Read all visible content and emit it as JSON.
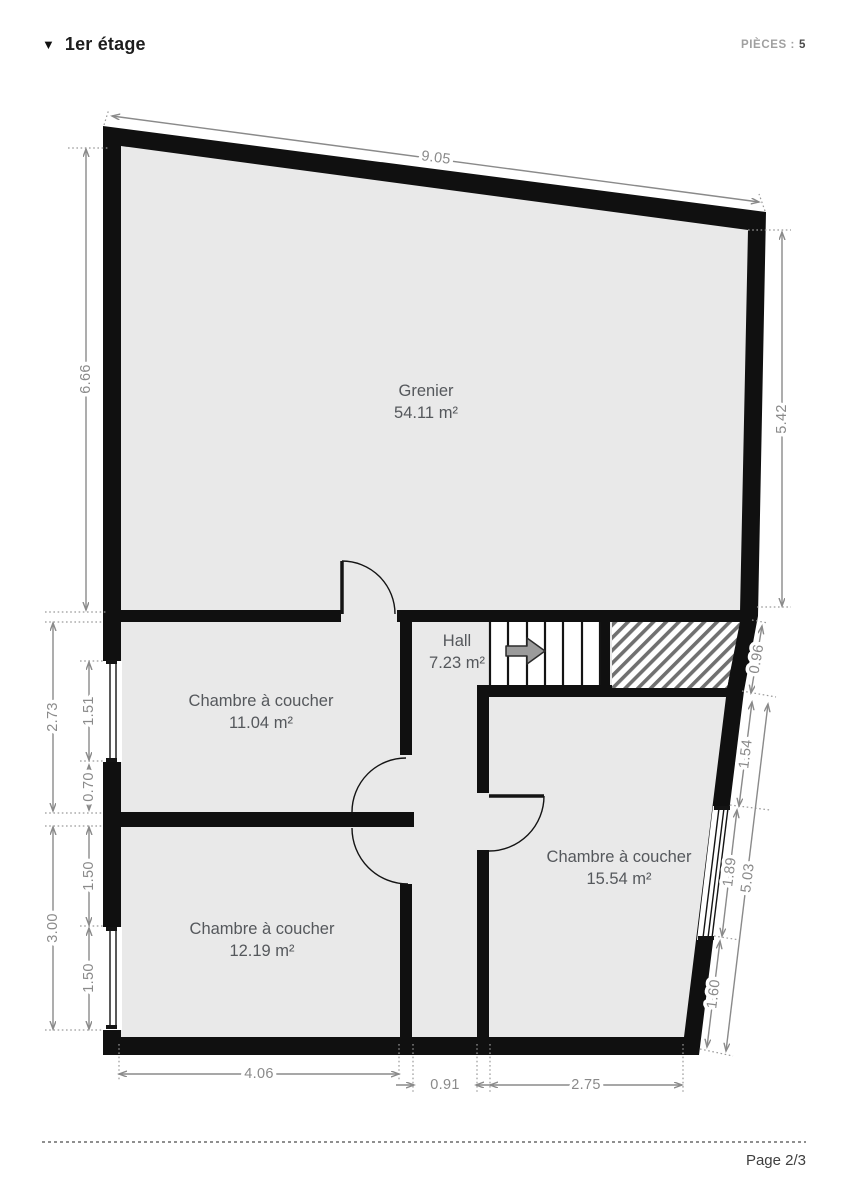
{
  "header": {
    "collapse_icon": "▼",
    "title": "1er étage",
    "rooms_label": "PIÈCES :",
    "rooms_count": "5"
  },
  "floorplan": {
    "rooms": {
      "grenier": {
        "name": "Grenier",
        "area": "54.11 m²"
      },
      "hall": {
        "name": "Hall",
        "area": "7.23 m²"
      },
      "bedroom_upper_left": {
        "name": "Chambre à coucher",
        "area": "11.04 m²"
      },
      "bedroom_right": {
        "name": "Chambre à coucher",
        "area": "15.54 m²"
      },
      "bedroom_lower_left": {
        "name": "Chambre à coucher",
        "area": "12.19 m²"
      }
    },
    "dimensions": {
      "top_width": "9.05",
      "left_upper_height": "6.66",
      "right_upper_height": "5.42",
      "left_mid_total": "2.73",
      "left_mid_window": "1.51",
      "left_mid_below_window": "0.70",
      "left_lower_total": "3.00",
      "left_lower_above_window": "1.50",
      "left_lower_window": "1.50",
      "bottom_left_room": "4.06",
      "bottom_corridor": "0.91",
      "bottom_right_room": "2.75",
      "right_hatch_edge": "0.96",
      "right_upper_segment": "1.54",
      "right_window": "1.89",
      "right_lower_segment": "1.60",
      "right_total": "5.03"
    }
  },
  "footer": {
    "page_label": "Page 2/3"
  },
  "colors": {
    "wall": "#101010",
    "floor": "#e9e9e9",
    "dim": "#8a8a8a",
    "label": "#55585c",
    "ink": "#1d1d1d"
  }
}
